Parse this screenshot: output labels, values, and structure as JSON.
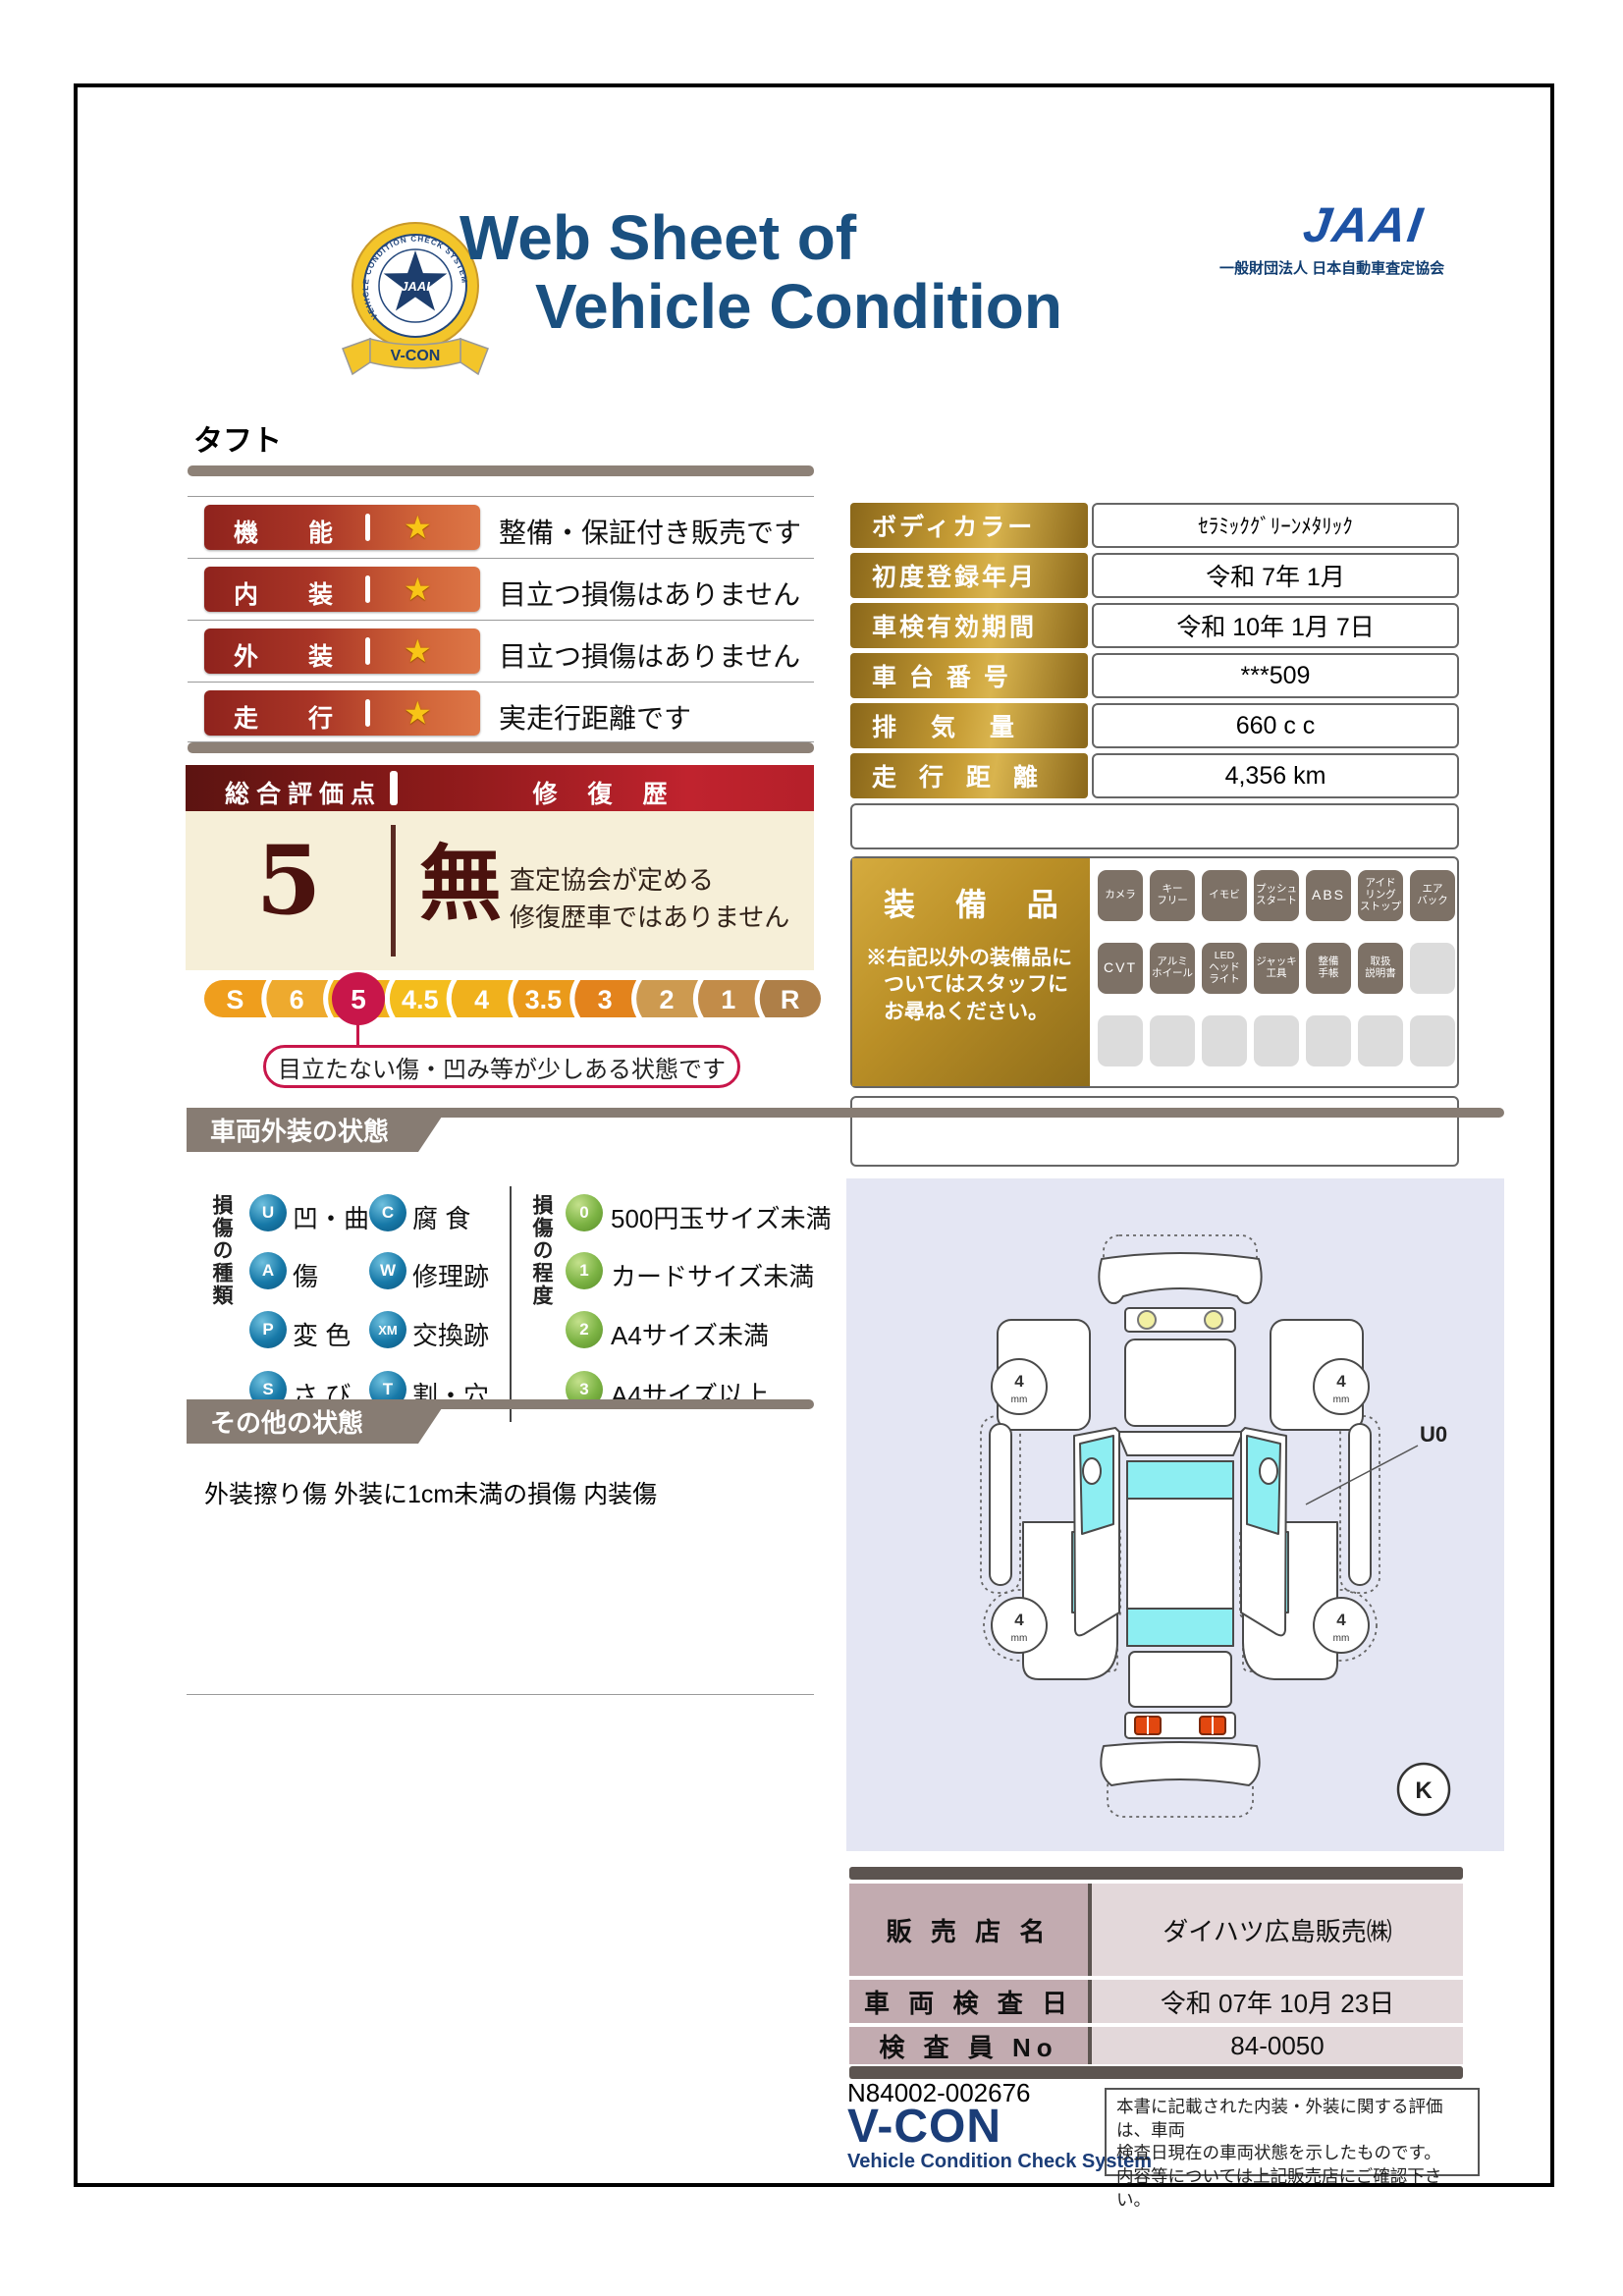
{
  "header": {
    "badge": {
      "ring_text": "VEHICLE CONDITION CHECK SYSTEM",
      "star_text": "JAAI",
      "ribbon_text": "V-CON"
    },
    "title_line1": "Web Sheet of",
    "title_line2": "Vehicle Condition",
    "jaai_logo": "JAAI",
    "jaai_org": "一般財団法人 日本自動車査定協会"
  },
  "vehicle_name": "タフト",
  "ratings": {
    "rows": [
      {
        "char1": "機",
        "char2": "能",
        "star": "★",
        "desc": "整備・保証付き販売です"
      },
      {
        "char1": "内",
        "char2": "装",
        "star": "★",
        "desc": "目立つ損傷はありません"
      },
      {
        "char1": "外",
        "char2": "装",
        "star": "★",
        "desc": "目立つ損傷はありません"
      },
      {
        "char1": "走",
        "char2": "行",
        "star": "★",
        "desc": "実走行距離です"
      }
    ]
  },
  "score": {
    "header_left": "総合評価点",
    "header_right": "修 復 歴",
    "value": "5",
    "repair_status": "無",
    "repair_note1": "査定協会が定める",
    "repair_note2": "修復歴車ではありません"
  },
  "scale": {
    "items": [
      "S",
      "6",
      "5",
      "4.5",
      "4",
      "3.5",
      "3",
      "2",
      "1",
      "R"
    ],
    "segment_colors": [
      "#ef9e1d",
      "#eeaa2e",
      "#f1b11d",
      "#f4bd1d",
      "#f0b11c",
      "#ea9a1b",
      "#e3831c",
      "#cd9a50",
      "#c28c49",
      "#ae7f48"
    ],
    "selected": "5",
    "selected_color": "#c8164a",
    "callout": "目立たない傷・凹み等が少しある状態です"
  },
  "specs": {
    "rows": [
      {
        "label": "ボディカラー",
        "value": "ｾﾗﾐｯｸｸﾞﾘｰﾝﾒﾀﾘｯｸ"
      },
      {
        "label": "初度登録年月",
        "value": "令和 7年 1月"
      },
      {
        "label": "車検有効期間",
        "value": "令和 10年 1月 7日"
      },
      {
        "label": "車 台 番 号",
        "value": "***509"
      },
      {
        "label": "排 気 量",
        "value": "660 c c"
      },
      {
        "label": "走 行 距 離",
        "value": "4,356 km"
      }
    ]
  },
  "equipment": {
    "title": "装 備 品",
    "note_line1": "※右記以外の装備品に",
    "note_line2": "ついてはスタッフに",
    "note_line3": "お尋ねください。",
    "r1b1l1": "カメラ",
    "r1b2l1": "キー",
    "r1b2l2": "フリー",
    "r1b3l1": "イモビ",
    "r1b4l1": "プッシュ",
    "r1b4l2": "スタート",
    "r1b5l1": "ABS",
    "r1b6l1": "アイド",
    "r1b6l2": "リング",
    "r1b6l3": "ストップ",
    "r1b7l1": "エア",
    "r1b7l2": "バック",
    "r2b1l1": "CVT",
    "r2b2l1": "アルミ",
    "r2b2l2": "ホイール",
    "r2b3l1": "LED",
    "r2b3l2": "ヘッド",
    "r2b3l3": "ライト",
    "r2b4l1": "ジャッキ",
    "r2b4l2": "工具",
    "r2b5l1": "整備",
    "r2b5l2": "手帳",
    "r2b6l1": "取扱",
    "r2b6l2": "説明書"
  },
  "exterior": {
    "header": "車両外装の状態",
    "type_label": "損傷の種類",
    "types": [
      {
        "code": "U",
        "label": "凹・曲"
      },
      {
        "code": "C",
        "label": "腐 食"
      },
      {
        "code": "A",
        "label": "傷"
      },
      {
        "code": "W",
        "label": "修理跡"
      },
      {
        "code": "P",
        "label": "変 色"
      },
      {
        "code": "XM",
        "label": "交換跡"
      },
      {
        "code": "S",
        "label": "さ び"
      },
      {
        "code": "T",
        "label": "割・穴"
      }
    ],
    "degree_label": "損傷の程度",
    "degrees": [
      {
        "code": "0",
        "label": "500円玉サイズ未満"
      },
      {
        "code": "1",
        "label": "カードサイズ未満"
      },
      {
        "code": "2",
        "label": "A4サイズ未満"
      },
      {
        "code": "3",
        "label": "A4サイズ以上"
      }
    ]
  },
  "other": {
    "header": "その他の状態",
    "note": "外装擦り傷 外装に1cm未満の損傷 内装傷"
  },
  "diagram": {
    "tire_value": "4",
    "tire_unit": "mm",
    "damage_label": "U0",
    "key_label": "K"
  },
  "dealer": {
    "rows": [
      {
        "label": "販 売 店 名",
        "value": "ダイハツ広島販売㈱"
      },
      {
        "label": "車 両 検 査 日",
        "value": "令和 07年 10月 23日"
      },
      {
        "label": "検 査 員 No",
        "value": "84-0050"
      }
    ]
  },
  "footer": {
    "serial": "N84002-002676",
    "logo": "V-CON",
    "logo_sub": "Vehicle Condition Check System",
    "note_line1": "本書に記載された内装・外装に関する評価は、車両",
    "note_line2": "検査日現在の車両状態を示したものです。",
    "note_line3": "内容等については上記販売店にご確認下さい。"
  }
}
